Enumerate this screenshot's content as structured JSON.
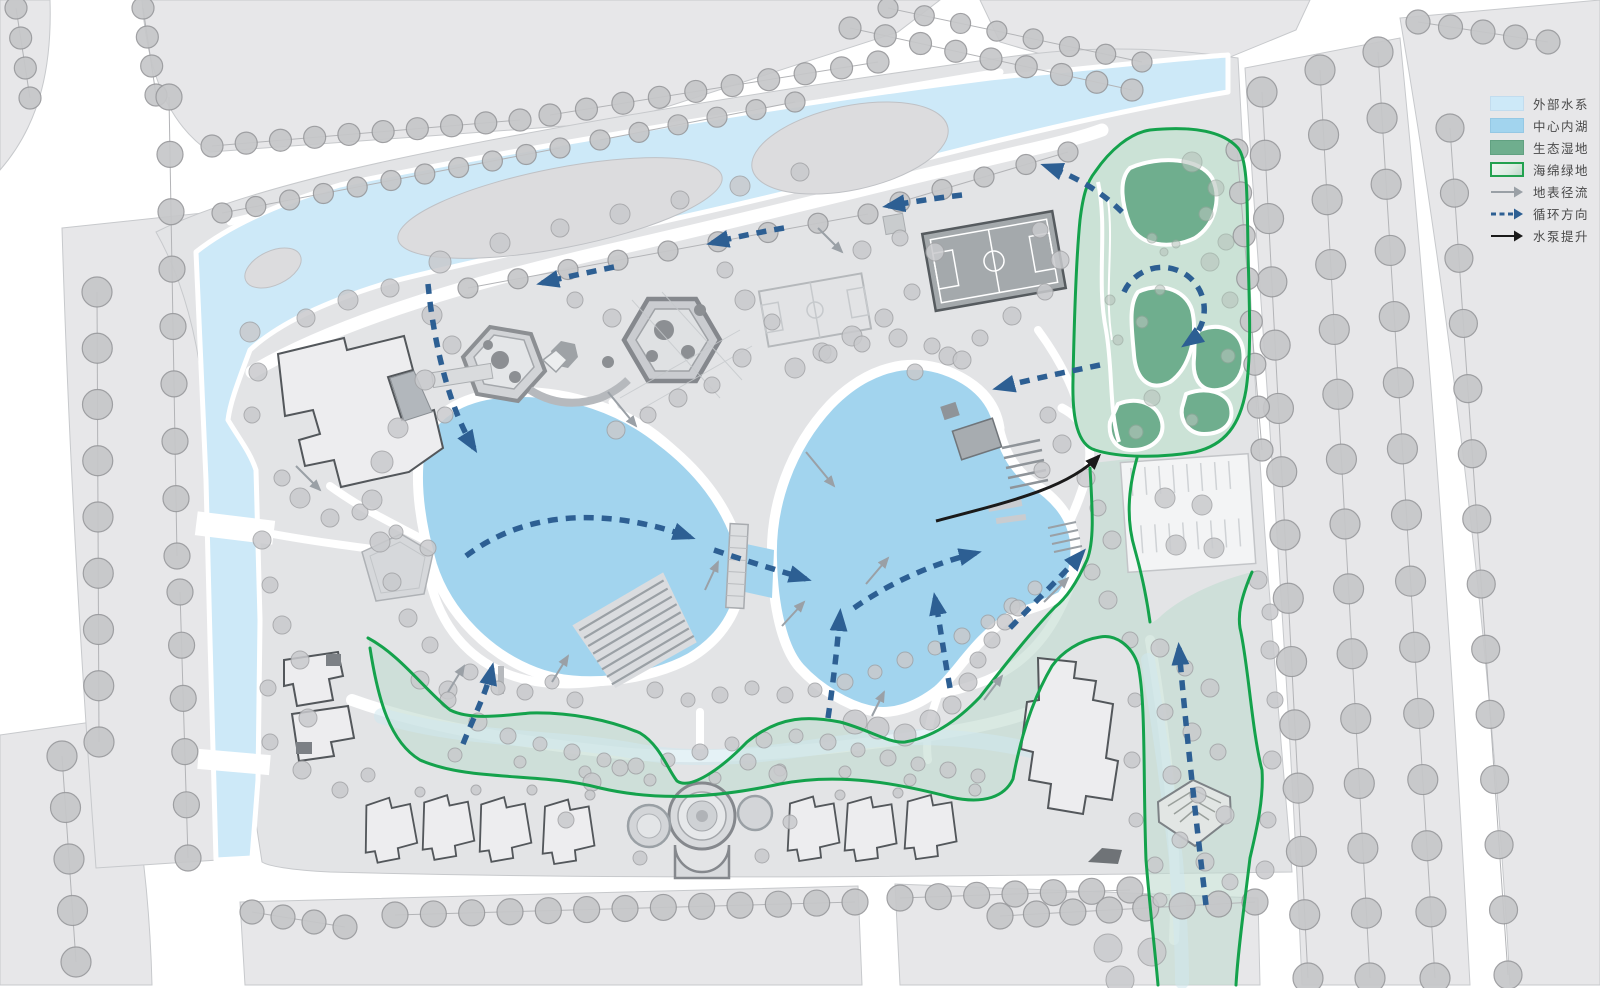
{
  "legend": {
    "items": [
      {
        "id": "external-water",
        "label": "外部水系",
        "glyph": "swatch",
        "color": "#cde9f8",
        "border": "#c2dcee"
      },
      {
        "id": "central-lake",
        "label": "中心内湖",
        "glyph": "swatch",
        "color": "#a2d4ee",
        "border": "#95c8e4"
      },
      {
        "id": "eco-wetland",
        "label": "生态湿地",
        "glyph": "swatch",
        "color": "#6fae8e",
        "border": "#61a181"
      },
      {
        "id": "sponge-green",
        "label": "海绵绿地",
        "glyph": "swatch-outlined",
        "color": "#dcebe2",
        "border": "#22a14f"
      },
      {
        "id": "surface-runoff",
        "label": "地表径流",
        "glyph": "arrow-thin",
        "color": "#9aa0a6"
      },
      {
        "id": "circulation-direction",
        "label": "循环方向",
        "glyph": "arrow-dashed",
        "color": "#2d5f93"
      },
      {
        "id": "pump-lift",
        "label": "水泵提升",
        "glyph": "arrow-solid",
        "color": "#1a1a1a"
      }
    ]
  },
  "palette": {
    "background": "#ffffff",
    "parcel": "#e7e7e9",
    "site": "#e3e4e6",
    "road_line": "#c7c9cc",
    "river": "#cde9f8",
    "lake": "#a2d4ee",
    "island": "#dcdcde",
    "tree_fill": "#c6c7c9",
    "tree_stroke": "#98999c",
    "wetland_fill": "#cbe2d6",
    "wetland_pond": "#6fae8e",
    "sponge_fill": "#c2dcd1",
    "swale_tint": "#cfe7ee",
    "green_line": "#14a24c",
    "blue_arrow": "#2d5f93",
    "gray_arrow": "#9aa0a6",
    "black_arrow": "#1a1a1a",
    "building_fill": "#ededef",
    "building_stroke": "#53575b",
    "court_dark": "#a4a9ac",
    "hardscape": "#d8dadd"
  }
}
